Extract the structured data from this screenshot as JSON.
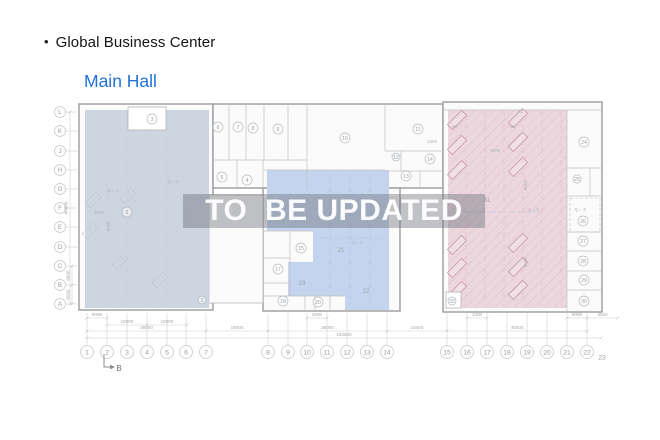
{
  "header": {
    "bullet": "•",
    "title": "Global Business Center",
    "subtitle": "Main Hall"
  },
  "watermark": {
    "text": "TO  BE UPDATED"
  },
  "colors": {
    "title": "#141414",
    "subtitle": "#2273d7",
    "background": "#ffffff",
    "wall": "#a2a2a2",
    "partition": "#c0c0c0",
    "block_fill": "#fbfbfb",
    "left_region": "#cdd5e0",
    "middle_region": "#c5d4ee",
    "right_region": "#ecd7de",
    "hatch": "#c996a8",
    "rack": "#c58fa3",
    "machine": "#b7c0cd",
    "grid_stroke": "#c7cacd",
    "grid_text": "#9b9ea3",
    "dim": "#cdd0d3",
    "dim_text": "#a3a7ab",
    "room_stroke": "#b4b8bc",
    "room_text": "#9aa0a6",
    "annotation": "#aeb2b6",
    "watermark_band": "rgba(104,110,120,0.42)",
    "watermark_text": "rgba(255,255,255,0.95)",
    "section": "#6f7control3",
    "section_stroke": "#8a8e92",
    "texture_left": "#c2cad6",
    "texture_mid": "#aebfdd",
    "texture_right": "#dcbac7"
  },
  "plan": {
    "blocks": [
      {
        "name": "left-hall",
        "x": 79,
        "y": 104,
        "w": 134,
        "h": 206
      },
      {
        "name": "top-middle-block",
        "x": 213,
        "y": 104,
        "w": 230,
        "h": 84
      },
      {
        "name": "bottom-middle-block",
        "x": 263,
        "y": 188,
        "w": 137,
        "h": 123
      },
      {
        "name": "right-hall",
        "x": 443,
        "y": 102,
        "w": 159,
        "h": 210
      },
      {
        "name": "corridor",
        "x": 209,
        "y": 195,
        "w": 54,
        "h": 108,
        "thin": true
      }
    ],
    "regions": [
      {
        "name": "left-zone",
        "color": "left_region",
        "points": [
          [
            85,
            110
          ],
          [
            128,
            110
          ],
          [
            128,
            130
          ],
          [
            166,
            130
          ],
          [
            166,
            110
          ],
          [
            209,
            110
          ],
          [
            209,
            308
          ],
          [
            85,
            308
          ]
        ]
      },
      {
        "name": "middle-zone",
        "color": "middle_region",
        "points": [
          [
            267,
            170
          ],
          [
            389,
            170
          ],
          [
            389,
            310
          ],
          [
            345,
            310
          ],
          [
            345,
            296
          ],
          [
            288,
            296
          ],
          [
            288,
            262
          ],
          [
            313,
            262
          ],
          [
            313,
            231
          ],
          [
            267,
            231
          ]
        ]
      },
      {
        "name": "right-zone",
        "color": "right_region",
        "hatch": true,
        "points": [
          [
            448,
            110
          ],
          [
            567,
            110
          ],
          [
            567,
            308
          ],
          [
            448,
            308
          ]
        ]
      }
    ],
    "partitions": [
      [
        213,
        160,
        307,
        160
      ],
      [
        229,
        104,
        229,
        160
      ],
      [
        246,
        104,
        246,
        160
      ],
      [
        264,
        104,
        264,
        160
      ],
      [
        288,
        104,
        288,
        160
      ],
      [
        307,
        104,
        307,
        188
      ],
      [
        237,
        160,
        237,
        188
      ],
      [
        263,
        160,
        263,
        188
      ],
      [
        385,
        104,
        385,
        151
      ],
      [
        385,
        151,
        443,
        151
      ],
      [
        401,
        151,
        401,
        171
      ],
      [
        385,
        171,
        443,
        171
      ],
      [
        420,
        171,
        420,
        188
      ],
      [
        264,
        170,
        385,
        170
      ],
      [
        263,
        231,
        313,
        231
      ],
      [
        290,
        231,
        290,
        296
      ],
      [
        263,
        258,
        290,
        258
      ],
      [
        263,
        283,
        290,
        283
      ],
      [
        263,
        296,
        345,
        296
      ],
      [
        305,
        296,
        305,
        311
      ],
      [
        315,
        296,
        315,
        311
      ],
      [
        330,
        296,
        330,
        311
      ],
      [
        443,
        110,
        602,
        110
      ],
      [
        567,
        110,
        567,
        312
      ],
      [
        567,
        168,
        602,
        168
      ],
      [
        590,
        168,
        590,
        196
      ],
      [
        567,
        196,
        602,
        196
      ],
      [
        567,
        232,
        602,
        232
      ],
      [
        567,
        251,
        602,
        251
      ],
      [
        567,
        271,
        602,
        271
      ],
      [
        567,
        290,
        602,
        290
      ]
    ],
    "texture_left_x": [
      107,
      127,
      147,
      167,
      187
    ],
    "texture_left_y": [
      112,
      306
    ],
    "texture_mid_x": [
      330,
      350,
      370
    ],
    "texture_mid_y": [
      175,
      306
    ],
    "texture_right_x": [
      466,
      485,
      504,
      523,
      542,
      561
    ],
    "texture_right_y": [
      112,
      306
    ],
    "dashed_lines": [
      [
        315,
        238,
        388,
        238
      ],
      [
        448,
        212,
        540,
        212
      ]
    ],
    "white_boxes": [
      {
        "x": 128,
        "y": 107,
        "w": 38,
        "h": 23
      },
      {
        "x": 446,
        "y": 292,
        "w": 15,
        "h": 16
      }
    ],
    "dashed_box": {
      "x": 570,
      "y": 198,
      "w": 30,
      "h": 34
    },
    "racks": {
      "w": 20,
      "h": 7,
      "rot": -45,
      "positions": [
        [
          457,
          120
        ],
        [
          457,
          145
        ],
        [
          457,
          170
        ],
        [
          457,
          245
        ],
        [
          457,
          268
        ],
        [
          457,
          291
        ],
        [
          518,
          118
        ],
        [
          518,
          142
        ],
        [
          518,
          167
        ],
        [
          518,
          243
        ],
        [
          518,
          267
        ],
        [
          518,
          290
        ]
      ]
    },
    "machines": {
      "w": 15,
      "h": 7,
      "rot": -45,
      "positions": [
        [
          93,
          200
        ],
        [
          90,
          231
        ],
        [
          128,
          196
        ],
        [
          120,
          262
        ],
        [
          160,
          280
        ]
      ]
    },
    "rooms": [
      {
        "n": "1",
        "x": 202,
        "y": 300,
        "r": 4
      },
      {
        "n": "2",
        "x": 127,
        "y": 212
      },
      {
        "n": "3",
        "x": 152,
        "y": 119
      },
      {
        "n": "4",
        "x": 247,
        "y": 180
      },
      {
        "n": "5",
        "x": 222,
        "y": 177
      },
      {
        "n": "6",
        "x": 218,
        "y": 127
      },
      {
        "n": "7",
        "x": 238,
        "y": 127
      },
      {
        "n": "8",
        "x": 253,
        "y": 128
      },
      {
        "n": "9",
        "x": 278,
        "y": 129
      },
      {
        "n": "10",
        "x": 345,
        "y": 138
      },
      {
        "n": "11",
        "x": 418,
        "y": 129
      },
      {
        "n": "12",
        "x": 396,
        "y": 157,
        "r": 4
      },
      {
        "n": "13",
        "x": 406,
        "y": 176
      },
      {
        "n": "14",
        "x": 430,
        "y": 159
      },
      {
        "n": "15",
        "x": 301,
        "y": 248
      },
      {
        "n": "17",
        "x": 278,
        "y": 269
      },
      {
        "n": "18",
        "x": 283,
        "y": 301
      },
      {
        "n": "20",
        "x": 318,
        "y": 302
      },
      {
        "n": "24",
        "x": 584,
        "y": 142
      },
      {
        "n": "25",
        "x": 577,
        "y": 179,
        "r": 4
      },
      {
        "n": "26",
        "x": 583,
        "y": 221
      },
      {
        "n": "27",
        "x": 583,
        "y": 241
      },
      {
        "n": "28",
        "x": 583,
        "y": 261
      },
      {
        "n": "29",
        "x": 584,
        "y": 280
      },
      {
        "n": "30",
        "x": 584,
        "y": 301
      },
      {
        "n": "32",
        "x": 452,
        "y": 301,
        "r": 4
      }
    ],
    "zone_labels": [
      {
        "t": "19",
        "x": 302,
        "y": 285
      },
      {
        "t": "21",
        "x": 341,
        "y": 252
      },
      {
        "t": "22",
        "x": 366,
        "y": 293
      },
      {
        "t": "31",
        "x": 487,
        "y": 202
      }
    ],
    "annotations": [
      {
        "t": "Q = 3",
        "x": 113,
        "y": 192
      },
      {
        "t": "Q = 3",
        "x": 173,
        "y": 183
      },
      {
        "t": "2000",
        "x": 99,
        "y": 214
      },
      {
        "t": "5000",
        "x": 110,
        "y": 226,
        "rot": -90
      },
      {
        "t": "Q = 3",
        "x": 357,
        "y": 244
      },
      {
        "t": "Q = 3",
        "x": 533,
        "y": 211
      },
      {
        "t": "Q = 3",
        "x": 580,
        "y": 211
      },
      {
        "t": "1300",
        "x": 432,
        "y": 143
      },
      {
        "t": "1900",
        "x": 495,
        "y": 152
      },
      {
        "t": "23",
        "x": 520,
        "y": 113
      },
      {
        "t": "45°",
        "x": 455,
        "y": 128
      },
      {
        "t": "45°",
        "x": 513,
        "y": 128
      },
      {
        "t": "6000",
        "x": 527,
        "y": 185,
        "rot": -90
      },
      {
        "t": "6000",
        "x": 527,
        "y": 262,
        "rot": -90
      }
    ],
    "grid_rows": {
      "cx": 60,
      "r": 5.5,
      "edge_x": 79,
      "labels": [
        {
          "t": "L",
          "y": 112
        },
        {
          "t": "K",
          "y": 131
        },
        {
          "t": "J",
          "y": 151
        },
        {
          "t": "H",
          "y": 170
        },
        {
          "t": "G",
          "y": 189
        },
        {
          "t": "F",
          "y": 208
        },
        {
          "t": "E",
          "y": 227
        },
        {
          "t": "D",
          "y": 247
        },
        {
          "t": "C",
          "y": 266
        },
        {
          "t": "B",
          "y": 285
        },
        {
          "t": "A",
          "y": 304
        }
      ]
    },
    "grid_cols": {
      "cy": 352,
      "r": 6.5,
      "edge_y": 313,
      "labels": [
        {
          "t": "1",
          "x": 87
        },
        {
          "t": "2",
          "x": 107
        },
        {
          "t": "3",
          "x": 127
        },
        {
          "t": "4",
          "x": 147
        },
        {
          "t": "5",
          "x": 167
        },
        {
          "t": "6",
          "x": 186
        },
        {
          "t": "7",
          "x": 206
        },
        {
          "t": "8",
          "x": 268
        },
        {
          "t": "9",
          "x": 288
        },
        {
          "t": "10",
          "x": 307
        },
        {
          "t": "11",
          "x": 327
        },
        {
          "t": "12",
          "x": 347
        },
        {
          "t": "13",
          "x": 367
        },
        {
          "t": "14",
          "x": 387
        },
        {
          "t": "15",
          "x": 447
        },
        {
          "t": "16",
          "x": 467
        },
        {
          "t": "17",
          "x": 487
        },
        {
          "t": "18",
          "x": 507
        },
        {
          "t": "19",
          "x": 527
        },
        {
          "t": "20",
          "x": 547
        },
        {
          "t": "21",
          "x": 567
        },
        {
          "t": "22",
          "x": 587
        },
        {
          "t": "23",
          "x": 602,
          "plain": true,
          "dy": 5
        }
      ]
    },
    "dims_h": [
      {
        "t": "6000",
        "x1": 87,
        "x2": 107,
        "y": 318
      },
      {
        "t": "2000",
        "x1": 307,
        "x2": 327,
        "y": 318
      },
      {
        "t": "1300",
        "x1": 467,
        "x2": 487,
        "y": 318
      },
      {
        "t": "6000",
        "x1": 567,
        "x2": 587,
        "y": 318
      },
      {
        "t": "3000",
        "x1": 587,
        "x2": 618,
        "y": 318
      },
      {
        "t": "18000",
        "x1": 107,
        "x2": 147,
        "y": 325
      },
      {
        "t": "18000",
        "x1": 147,
        "x2": 187,
        "y": 325
      },
      {
        "t": "36000",
        "x1": 87,
        "x2": 206,
        "y": 331
      },
      {
        "t": "18000",
        "x1": 206,
        "x2": 268,
        "y": 331
      },
      {
        "t": "36000",
        "x1": 268,
        "x2": 387,
        "y": 331
      },
      {
        "t": "18400",
        "x1": 387,
        "x2": 447,
        "y": 331
      },
      {
        "t": "45000",
        "x1": 447,
        "x2": 587,
        "y": 331
      },
      {
        "t": "153600",
        "x1": 87,
        "x2": 601,
        "y": 338
      }
    ],
    "dims_v": [
      {
        "t": "60000",
        "x": 70,
        "y1": 112,
        "y2": 304
      },
      {
        "t": "6000",
        "x": 72,
        "y1": 266,
        "y2": 285
      },
      {
        "t": "6000",
        "x": 72,
        "y1": 285,
        "y2": 304
      }
    ],
    "section_marker": {
      "label": "B",
      "x": 104,
      "y1": 354,
      "y2": 367,
      "x2": 110
    }
  }
}
